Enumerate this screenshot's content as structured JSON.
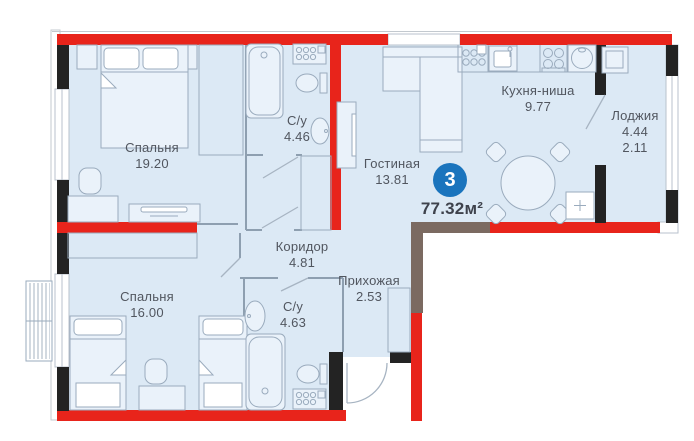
{
  "plan": {
    "apartment_number": "3",
    "total_area": "77.32м²",
    "rooms": [
      {
        "id": "bedroom1",
        "label": "Спальня",
        "area": "19.20"
      },
      {
        "id": "bath1",
        "label": "С/у",
        "area": "4.46"
      },
      {
        "id": "living",
        "label": "Гостиная",
        "area": "13.81"
      },
      {
        "id": "kitchen",
        "label": "Кухня-ниша",
        "area": "9.77"
      },
      {
        "id": "loggia",
        "label": "Лоджия",
        "area": "4.44",
        "area2": "2.11"
      },
      {
        "id": "corridor",
        "label": "Коридор",
        "area": "4.81"
      },
      {
        "id": "hallway",
        "label": "Прихожая",
        "area": "2.53"
      },
      {
        "id": "bedroom2",
        "label": "Спальня",
        "area": "16.00"
      },
      {
        "id": "bath2",
        "label": "С/у",
        "area": "4.63"
      }
    ],
    "icons": [
      "double-bed-icon",
      "single-bed-icon",
      "wardrobe-icon",
      "bathtub-icon",
      "toilet-icon",
      "sink-icon",
      "washer-icon",
      "hob-icon",
      "kitchen-sink-icon",
      "appliance-icon",
      "sofa-icon",
      "tv-icon",
      "tv-stand-icon",
      "dining-table-icon",
      "chair-icon",
      "desk-icon",
      "nightstand-icon",
      "entry-door-icon",
      "door-leaf-icon",
      "window-icon",
      "ac-basket-icon",
      "vent-shaft-icon",
      "loggia-cabinet-icon"
    ],
    "colors": {
      "red": "#e8241b",
      "black": "#232323",
      "brown": "#7b6a61",
      "floor": "#dce9f5",
      "line": "#9aabbd",
      "wallline": "#8e9fb0",
      "furn": "#eaf2fa",
      "text": "#51565f",
      "badge": "#1a74bd",
      "badge_text": "#ffffff",
      "total_text": "#3e424c"
    }
  }
}
